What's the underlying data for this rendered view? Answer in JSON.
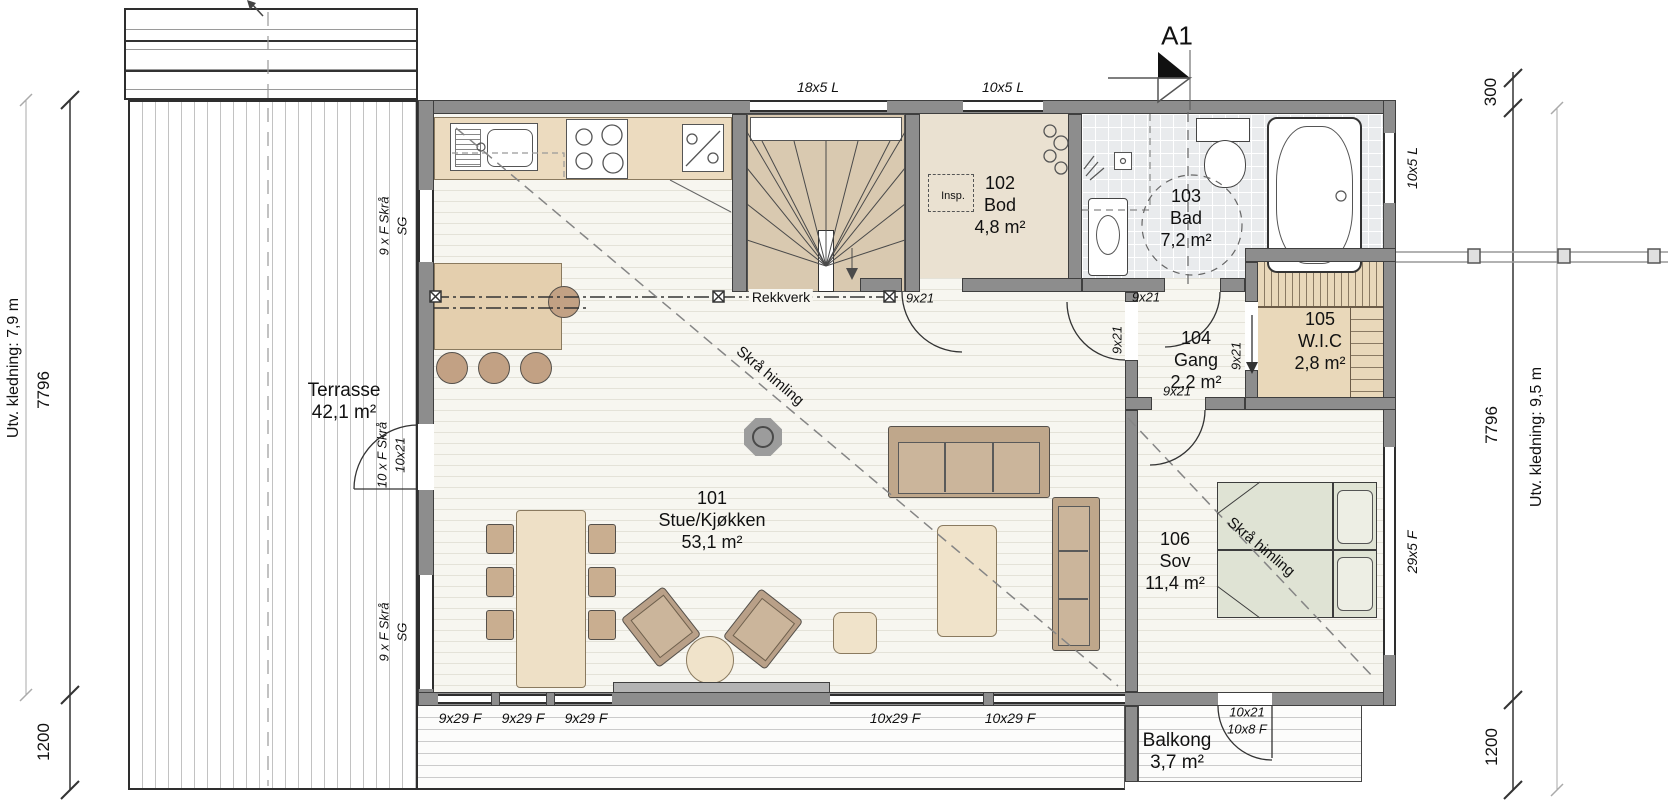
{
  "colors": {
    "wall": "#8d8d8d",
    "floor_stripe": "#e4e2d8",
    "counter_beige": "#ecdbbf",
    "stairs_tan": "#d9c9b0",
    "bod_floor": "#eae1d1",
    "tile_gray": "#e9ebed",
    "wic_floor": "#e9d8ba",
    "bed_green": "#dfe3d4",
    "furniture_tan": "#bfa78b"
  },
  "section_marker": {
    "label": "A1"
  },
  "rooms": {
    "terrasse": {
      "name": "Terrasse",
      "area": "42,1 m²"
    },
    "stue": {
      "number": "101",
      "name": "Stue/Kjøkken",
      "area": "53,1 m²"
    },
    "bod": {
      "number": "102",
      "name": "Bod",
      "area": "4,8 m²"
    },
    "bad": {
      "number": "103",
      "name": "Bad",
      "area": "7,2 m²"
    },
    "gang": {
      "number": "104",
      "name": "Gang",
      "area": "2,2 m²"
    },
    "wic": {
      "number": "105",
      "name": "W.I.C",
      "area": "2,8 m²"
    },
    "sov": {
      "number": "106",
      "name": "Sov",
      "area": "11,4 m²"
    },
    "balkong": {
      "name": "Balkong",
      "area": "3,7 m²"
    }
  },
  "annotations": {
    "rekkverk": "Rekkverk",
    "skraa_himling_stue": "Skrå himling",
    "skraa_himling_sov": "Skrå himling",
    "inspection_hatch": "Insp."
  },
  "windows": {
    "top_stair": "18x5 L",
    "top_bod": "10x5 L",
    "right_bad": "10x5 L",
    "right_sov": "29x5 F",
    "bottom_stue": [
      "9x29 F",
      "9x29 F",
      "9x29 F"
    ],
    "bottom_east": [
      "10x29 F",
      "10x29 F"
    ],
    "left_upper": {
      "line1": "9 x F Skrå",
      "line2": "SG"
    },
    "left_lower": {
      "line1": "9 x F Skrå",
      "line2": "SG"
    }
  },
  "doors": {
    "interior": [
      "9x21",
      "9x21",
      "9x21",
      "9x21",
      "9x21"
    ],
    "terrace": {
      "line1": "10 x F Skrå",
      "line2": "10x21"
    },
    "balcony": {
      "line1": "10x21",
      "line2": "10x8 F"
    }
  },
  "dimensions": {
    "left": {
      "cladding": "Utv. kledning: 7,9 m",
      "height": "7796",
      "bottom": "1200"
    },
    "right": {
      "top": "300",
      "cladding": "Utv. kledning: 9,5 m",
      "height": "7796",
      "bottom": "1200"
    }
  }
}
